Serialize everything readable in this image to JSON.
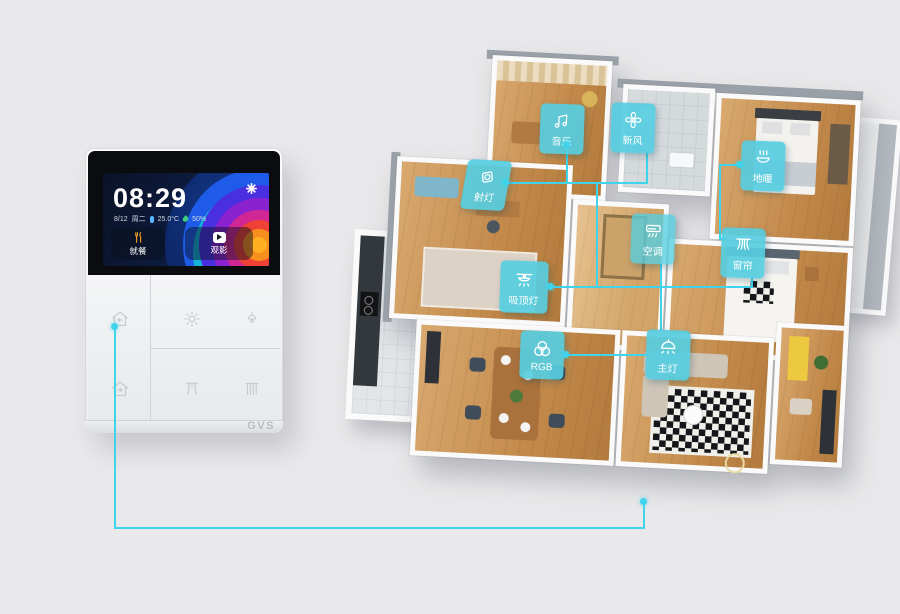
{
  "colors": {
    "background": "#e9e9eb",
    "accent_cyan": "#3fd4ec",
    "label_background": "#56cde0",
    "scene_highlight_yellow": "#f5a623"
  },
  "device": {
    "brand": "GVS",
    "screen": {
      "time": "08:29",
      "date": "8/12",
      "weekday": "周二",
      "temperature": "25.0°C",
      "humidity": "50%",
      "settings_icon": "gear-icon",
      "scenes": [
        {
          "label": "就餐",
          "icon": "dining-utensils-icon"
        },
        {
          "label": "观影",
          "icon": "movie-play-icon"
        }
      ]
    },
    "keys": [
      {
        "icon": "home-return-icon"
      },
      {
        "icon": "brightness-icon"
      },
      {
        "icon": "pendant-light-icon"
      },
      {
        "icon": "home-away-icon"
      },
      {
        "icon": "curtain-icon"
      },
      {
        "icon": "blinds-icon"
      }
    ]
  },
  "floorplan": {
    "labels": [
      {
        "id": "spotlight",
        "text": "射灯",
        "icon": "spotlight-icon"
      },
      {
        "id": "music",
        "text": "音乐",
        "icon": "music-note-icon"
      },
      {
        "id": "fresh-air",
        "text": "新风",
        "icon": "fan-icon"
      },
      {
        "id": "floor-heating",
        "text": "地暖",
        "icon": "heating-icon"
      },
      {
        "id": "ac",
        "text": "空调",
        "icon": "air-conditioner-icon"
      },
      {
        "id": "curtain",
        "text": "窗帘",
        "icon": "curtain-icon"
      },
      {
        "id": "ceiling-light",
        "text": "吸顶灯",
        "icon": "ceiling-light-icon"
      },
      {
        "id": "rgb",
        "text": "RGB",
        "icon": "rgb-circles-icon"
      },
      {
        "id": "main-light",
        "text": "主灯",
        "icon": "dome-light-icon"
      }
    ]
  }
}
